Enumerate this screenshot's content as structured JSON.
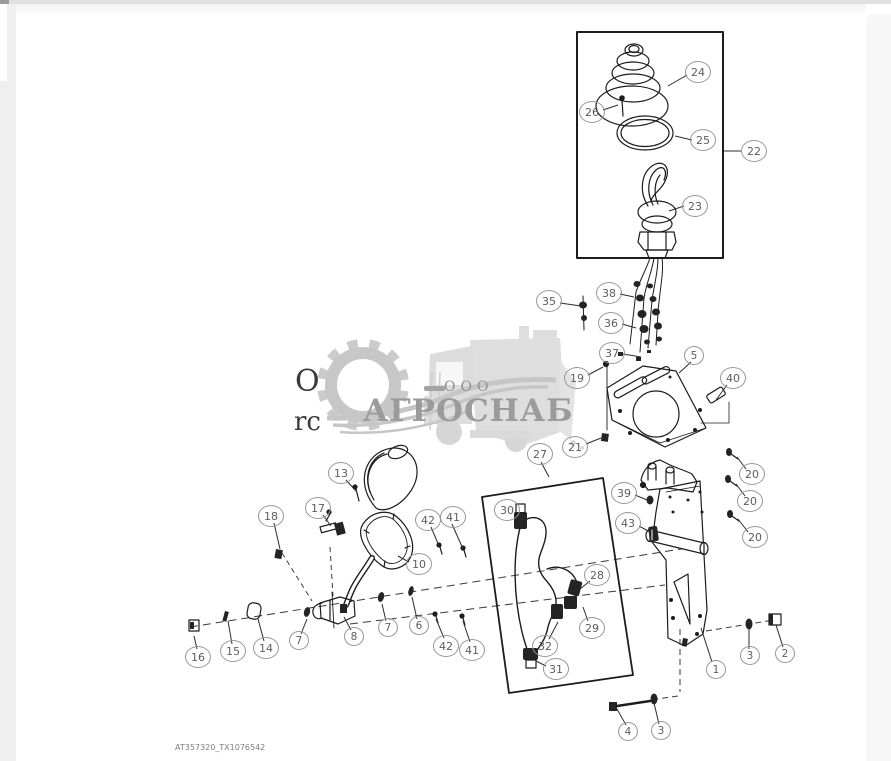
{
  "page": {
    "footer_code": "AT357320_TX1076542",
    "cropped_text_line1": "O",
    "cropped_text_line2": "rc"
  },
  "watermark": {
    "company_prefix": "ООО",
    "company_name": "АГРОСНАБ"
  },
  "callouts": [
    {
      "label": "24"
    },
    {
      "label": "26"
    },
    {
      "label": "25"
    },
    {
      "label": "23"
    },
    {
      "label": "22"
    },
    {
      "label": "35"
    },
    {
      "label": "38"
    },
    {
      "label": "36"
    },
    {
      "label": "37"
    },
    {
      "label": "5"
    },
    {
      "label": "19"
    },
    {
      "label": "40"
    },
    {
      "label": "21"
    },
    {
      "label": "27"
    },
    {
      "label": "39"
    },
    {
      "label": "43"
    },
    {
      "label": "20"
    },
    {
      "label": "20"
    },
    {
      "label": "20"
    },
    {
      "label": "30"
    },
    {
      "label": "28"
    },
    {
      "label": "29"
    },
    {
      "label": "32"
    },
    {
      "label": "31"
    },
    {
      "label": "13"
    },
    {
      "label": "17"
    },
    {
      "label": "18"
    },
    {
      "label": "42"
    },
    {
      "label": "41"
    },
    {
      "label": "10"
    },
    {
      "label": "16"
    },
    {
      "label": "15"
    },
    {
      "label": "14"
    },
    {
      "label": "7"
    },
    {
      "label": "8"
    },
    {
      "label": "7"
    },
    {
      "label": "6"
    },
    {
      "label": "42"
    },
    {
      "label": "41"
    },
    {
      "label": "1"
    },
    {
      "label": "3"
    },
    {
      "label": "2"
    },
    {
      "label": "4"
    },
    {
      "label": "3"
    }
  ]
}
